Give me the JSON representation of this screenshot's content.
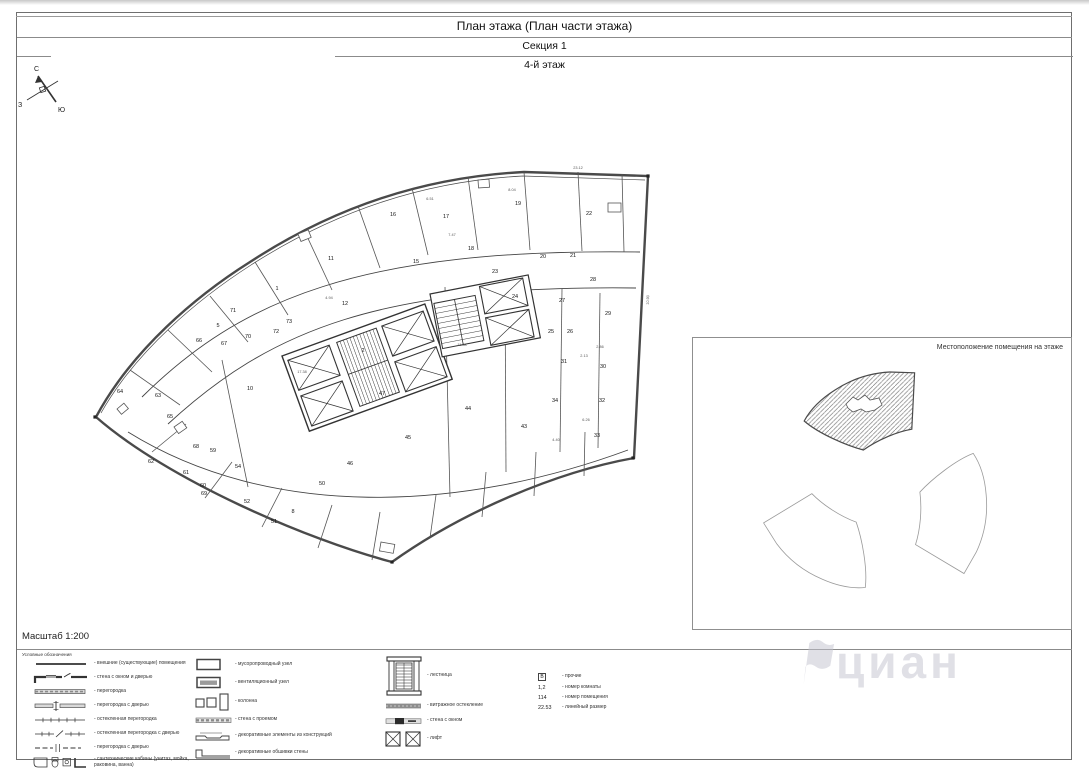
{
  "document": {
    "title": "План этажа (План части этажа)",
    "section": "Секция 1",
    "floor": "4-й этаж",
    "scale": "Масштаб 1:200",
    "watermark": "циан"
  },
  "compass": {
    "north": "С",
    "west": "З",
    "south": "Ю"
  },
  "location_map": {
    "title": "Местоположение помещения на этаже"
  },
  "legend": {
    "title": "Условные обозначения",
    "columns": [
      {
        "items": [
          {
            "icon": "boundary",
            "label": "- внешние (существующие) помещения"
          },
          {
            "icon": "wall_window_door",
            "label": "- стена с окном и дверью"
          },
          {
            "icon": "partition",
            "label": "- перегородка"
          },
          {
            "icon": "partition_door",
            "label": "- перегородка с дверью"
          },
          {
            "icon": "glazed",
            "label": "- остекленная перегородка"
          },
          {
            "icon": "glazed_door",
            "label": "- остекленная перегородка с дверью"
          },
          {
            "icon": "partition_door2",
            "label": "- перегородка с дверью"
          },
          {
            "icon": "sanitary",
            "label": "- сантехнические кабины (унитаз, мойка, раковина, ванна)"
          }
        ]
      },
      {
        "items": [
          {
            "icon": "vent_plain",
            "label": "- мусоропроводный узел"
          },
          {
            "icon": "vent_hatch",
            "label": "- вентиляционный узел"
          },
          {
            "icon": "columns",
            "label": "- колонна"
          },
          {
            "icon": "wall_opening",
            "label": "- стена с проемом"
          },
          {
            "icon": "decor_vent",
            "label": "- декоративные элементы из конструкций"
          },
          {
            "icon": "decor_wall",
            "label": "- декоративные обшивки стены"
          }
        ]
      },
      {
        "items": [
          {
            "icon": "stair",
            "label": "- лестница"
          },
          {
            "icon": "glazing",
            "label": "- витражное остекление"
          },
          {
            "icon": "wall_window_band",
            "label": "- стена с окном"
          },
          {
            "icon": "lift",
            "label": "- лифт"
          }
        ]
      },
      {
        "items": [
          {
            "symbol": "В",
            "boxed": true,
            "label": "- прочие"
          },
          {
            "symbol": "1,2",
            "label": "- номер комнаты"
          },
          {
            "symbol": "114",
            "label": "- номер помещения"
          },
          {
            "symbol": "22.53",
            "label": "- линейный размер"
          }
        ]
      }
    ]
  },
  "floor_plan": {
    "rooms": [
      {
        "n": "1",
        "x": 277,
        "y": 290
      },
      {
        "n": "2",
        "x": 363,
        "y": 352
      },
      {
        "n": "5",
        "x": 218,
        "y": 327
      },
      {
        "n": "8",
        "x": 293,
        "y": 513
      },
      {
        "n": "10",
        "x": 250,
        "y": 390
      },
      {
        "n": "11",
        "x": 331,
        "y": 260
      },
      {
        "n": "12",
        "x": 345,
        "y": 305
      },
      {
        "n": "15",
        "x": 416,
        "y": 263
      },
      {
        "n": "16",
        "x": 393,
        "y": 216
      },
      {
        "n": "17",
        "x": 446,
        "y": 218
      },
      {
        "n": "18",
        "x": 471,
        "y": 250
      },
      {
        "n": "19",
        "x": 518,
        "y": 205
      },
      {
        "n": "20",
        "x": 543,
        "y": 258
      },
      {
        "n": "21",
        "x": 573,
        "y": 257
      },
      {
        "n": "22",
        "x": 589,
        "y": 215
      },
      {
        "n": "23",
        "x": 495,
        "y": 273
      },
      {
        "n": "24",
        "x": 515,
        "y": 298
      },
      {
        "n": "25",
        "x": 551,
        "y": 333
      },
      {
        "n": "26",
        "x": 570,
        "y": 333
      },
      {
        "n": "27",
        "x": 562,
        "y": 302
      },
      {
        "n": "28",
        "x": 593,
        "y": 281
      },
      {
        "n": "29",
        "x": 608,
        "y": 315
      },
      {
        "n": "30",
        "x": 603,
        "y": 368
      },
      {
        "n": "31",
        "x": 564,
        "y": 363
      },
      {
        "n": "32",
        "x": 602,
        "y": 402
      },
      {
        "n": "33",
        "x": 597,
        "y": 437
      },
      {
        "n": "34",
        "x": 555,
        "y": 402
      },
      {
        "n": "43",
        "x": 524,
        "y": 428
      },
      {
        "n": "44",
        "x": 468,
        "y": 410
      },
      {
        "n": "45",
        "x": 408,
        "y": 439
      },
      {
        "n": "46",
        "x": 350,
        "y": 465
      },
      {
        "n": "47",
        "x": 382,
        "y": 395
      },
      {
        "n": "50",
        "x": 322,
        "y": 485
      },
      {
        "n": "51",
        "x": 274,
        "y": 523
      },
      {
        "n": "52",
        "x": 247,
        "y": 503
      },
      {
        "n": "54",
        "x": 238,
        "y": 468
      },
      {
        "n": "59",
        "x": 213,
        "y": 452
      },
      {
        "n": "60",
        "x": 203,
        "y": 487
      },
      {
        "n": "61",
        "x": 186,
        "y": 474
      },
      {
        "n": "62",
        "x": 151,
        "y": 463
      },
      {
        "n": "63",
        "x": 158,
        "y": 397
      },
      {
        "n": "64",
        "x": 120,
        "y": 393
      },
      {
        "n": "65",
        "x": 170,
        "y": 418
      },
      {
        "n": "66",
        "x": 199,
        "y": 342
      },
      {
        "n": "67",
        "x": 224,
        "y": 345
      },
      {
        "n": "68",
        "x": 196,
        "y": 448
      },
      {
        "n": "69",
        "x": 204,
        "y": 495
      },
      {
        "n": "70",
        "x": 248,
        "y": 338
      },
      {
        "n": "71",
        "x": 233,
        "y": 312
      },
      {
        "n": "72",
        "x": 276,
        "y": 333
      },
      {
        "n": "73",
        "x": 289,
        "y": 323
      }
    ],
    "dims": [
      {
        "v": "23.12",
        "x": 578,
        "y": 169
      },
      {
        "v": "10.90",
        "x": 649,
        "y": 300,
        "r": -87
      },
      {
        "v": "7.47",
        "x": 452,
        "y": 236
      },
      {
        "v": "6.51",
        "x": 430,
        "y": 200
      },
      {
        "v": "11.58",
        "x": 462,
        "y": 346
      },
      {
        "v": "4.94",
        "x": 329,
        "y": 299
      },
      {
        "v": "2.13",
        "x": 584,
        "y": 357
      },
      {
        "v": "17.38",
        "x": 302,
        "y": 373
      },
      {
        "v": "8.04",
        "x": 512,
        "y": 191
      },
      {
        "v": "2.86",
        "x": 600,
        "y": 348
      },
      {
        "v": "6.26",
        "x": 586,
        "y": 421
      },
      {
        "v": "4.40",
        "x": 556,
        "y": 441
      }
    ]
  }
}
